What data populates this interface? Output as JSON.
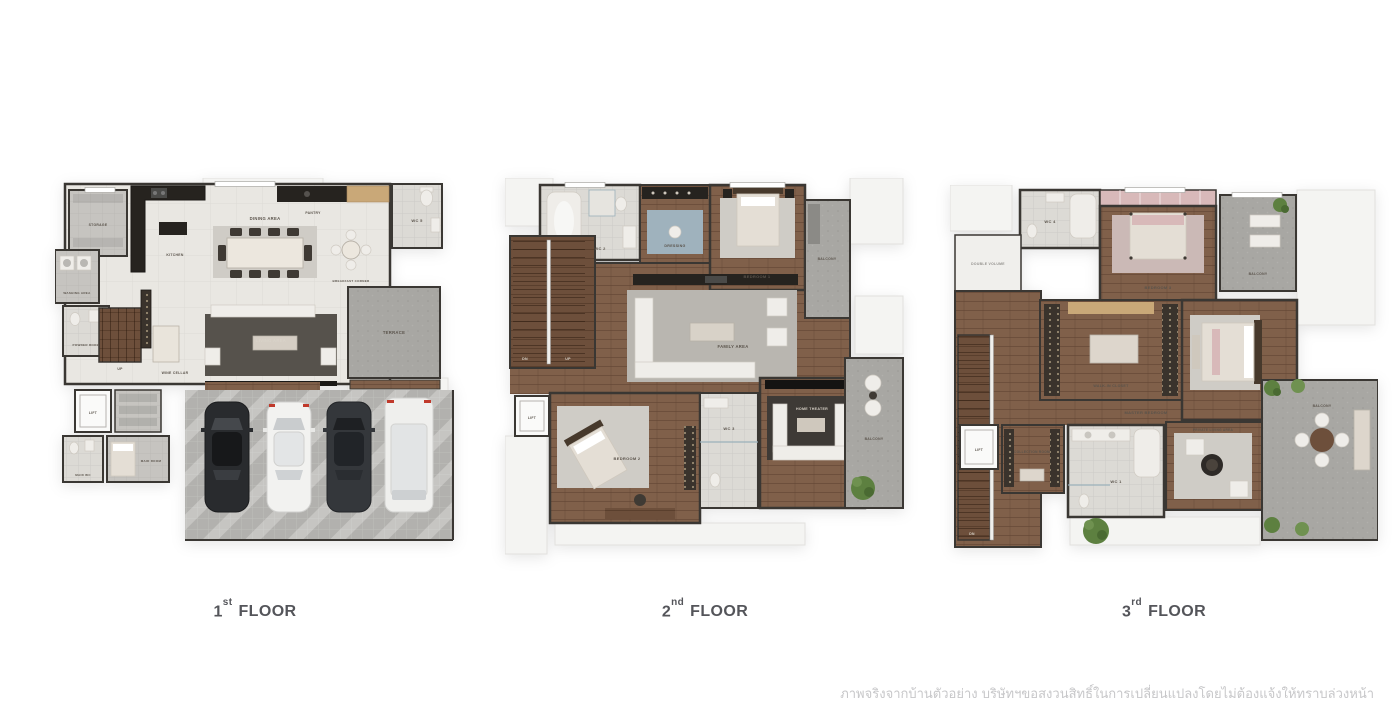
{
  "page": {
    "background": "#ffffff",
    "disclaimer": "ภาพจริงจากบ้านตัวอย่าง บริษัทฯขอสงวนสิทธิ์ในการเปลี่ยนแปลงโดยไม่ต้องแจ้งให้ทราบล่วงหน้า"
  },
  "palette": {
    "bg": "#ffffff",
    "wall": "#3a3733",
    "wood": "#80604a",
    "woodDark": "#6d4f3b",
    "marble": "#e9e7e2",
    "tile": "#dcdad5",
    "grey": "#a8a7a3",
    "greyLight": "#c6c4c0",
    "rugDark": "#56524c",
    "rugLight": "#cfccc6",
    "counter": "#26231f",
    "shelfWood": "#c9a878",
    "plant": "#5d8040",
    "bedlight": "#e4ded5",
    "pink": "#d8b9b9",
    "blue": "#9fb2bd",
    "label": "#5a534b",
    "labellight": "#d9d3c9",
    "title": "#54555a",
    "disclaimer": "#c7c7c9"
  },
  "floors": [
    {
      "number": "1",
      "ordinal": "st",
      "word": "FLOOR",
      "rooms": {
        "storage": "STORAGE",
        "kitchen": "KITCHEN",
        "pantry": "PANTRY",
        "wc": "WC 5",
        "washing": "WASHING AREA",
        "powder": "POWDER ROOM",
        "stairs_up": "UP",
        "wine": "WINE CELLAR",
        "dining": "DINING AREA",
        "breakfast": "BREAKFAST CORNER",
        "living": "LIVING AREA",
        "terrace": "TERRACE",
        "lift": "LIFT",
        "maid_wc": "MAID WC",
        "maid": "MAID ROOM"
      },
      "parking_cars": [
        "dark-sports-car",
        "white-sedan",
        "dark-sedan",
        "white-suv"
      ]
    },
    {
      "number": "2",
      "ordinal": "nd",
      "word": "FLOOR",
      "rooms": {
        "wc2": "WC 2",
        "dressing": "DRESSING",
        "bedroom1": "BEDROOM 1",
        "side_balcony": "BALCONY",
        "family": "FAMILY AREA",
        "stairs_dn": "DN",
        "stairs_up": "UP",
        "lift": "LIFT",
        "bedroom2": "BEDROOM 2",
        "wc3": "WC 3",
        "theater": "HOME THEATER",
        "balcony": "BALCONY"
      }
    },
    {
      "number": "3",
      "ordinal": "rd",
      "word": "FLOOR",
      "rooms": {
        "wc4": "WC 4",
        "double_volume": "DOUBLE VOLUME",
        "bedroom3": "BEDROOM 3",
        "balcony_top": "BALCONY",
        "walkin": "WALK-IN CLOSET",
        "master": "MASTER BEDROOM",
        "lift": "LIFT",
        "collection": "COLLECTION ROOM",
        "wc1": "WC 1",
        "private_living": "PRIVATE LIVING AREA",
        "balcony_right": "BALCONY",
        "stairs_dn": "DN"
      }
    }
  ]
}
